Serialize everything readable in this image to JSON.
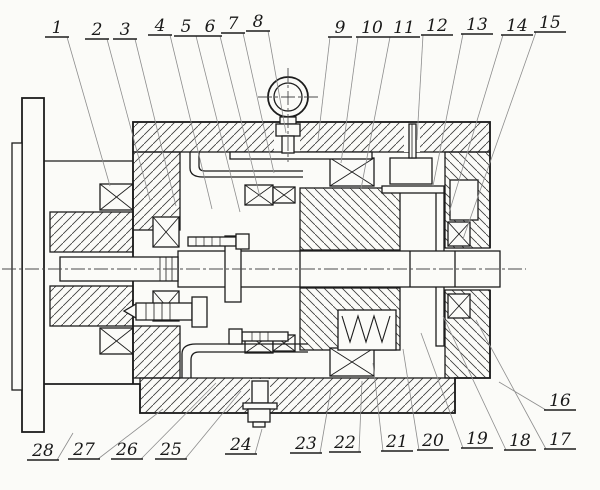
{
  "page": {
    "background": "#fbfbf8",
    "line_color": "#1c1c1c",
    "leader_color": "#8d8d8d",
    "description": "Mechanical assembly cross-section drawing with numbered part callouts 1-28"
  },
  "figure": {
    "part_numbers": [
      "1",
      "2",
      "3",
      "4",
      "5",
      "6",
      "7",
      "8",
      "9",
      "10",
      "11",
      "12",
      "13",
      "14",
      "15",
      "16",
      "17",
      "18",
      "19",
      "20",
      "21",
      "22",
      "23",
      "24",
      "25",
      "26",
      "27",
      "28"
    ],
    "part_labels": [
      {
        "number": "1",
        "x": 57,
        "y": 33,
        "tx": 110,
        "ty": 186,
        "attach": "right"
      },
      {
        "number": "2",
        "x": 97,
        "y": 35,
        "tx": 150,
        "ty": 200,
        "attach": "right"
      },
      {
        "number": "3",
        "x": 125,
        "y": 35,
        "tx": 176,
        "ty": 206,
        "attach": "right"
      },
      {
        "number": "4",
        "x": 160,
        "y": 31,
        "tx": 212,
        "ty": 209,
        "attach": "right"
      },
      {
        "number": "5",
        "x": 186,
        "y": 32,
        "tx": 240,
        "ty": 212,
        "attach": "right"
      },
      {
        "number": "6",
        "x": 210,
        "y": 32,
        "tx": 260,
        "ty": 197,
        "attach": "right"
      },
      {
        "number": "7",
        "x": 233,
        "y": 29,
        "tx": 274,
        "ty": 173,
        "attach": "right"
      },
      {
        "number": "8",
        "x": 258,
        "y": 27,
        "tx": 286,
        "ty": 133,
        "attach": "right"
      },
      {
        "number": "9",
        "x": 340,
        "y": 33,
        "tx": 318,
        "ty": 140,
        "attach": "left"
      },
      {
        "number": "10",
        "x": 372,
        "y": 33,
        "tx": 341,
        "ty": 163,
        "attach": "left"
      },
      {
        "number": "11",
        "x": 404,
        "y": 33,
        "tx": 361,
        "ty": 189,
        "attach": "left"
      },
      {
        "number": "12",
        "x": 437,
        "y": 31,
        "tx": 417,
        "ty": 140,
        "attach": "left"
      },
      {
        "number": "13",
        "x": 477,
        "y": 30,
        "tx": 433,
        "ty": 186,
        "attach": "left"
      },
      {
        "number": "14",
        "x": 517,
        "y": 31,
        "tx": 449,
        "ty": 213,
        "attach": "left"
      },
      {
        "number": "15",
        "x": 550,
        "y": 28,
        "tx": 463,
        "ty": 239,
        "attach": "left"
      },
      {
        "number": "16",
        "x": 560,
        "y": 406,
        "tx": 499,
        "ty": 382,
        "attach": "left"
      },
      {
        "number": "17",
        "x": 560,
        "y": 445,
        "tx": 476,
        "ty": 320,
        "attach": "left"
      },
      {
        "number": "18",
        "x": 520,
        "y": 446,
        "tx": 443,
        "ty": 316,
        "attach": "left"
      },
      {
        "number": "19",
        "x": 477,
        "y": 444,
        "tx": 421,
        "ty": 333,
        "attach": "left"
      },
      {
        "number": "20",
        "x": 433,
        "y": 446,
        "tx": 403,
        "ty": 349,
        "attach": "left"
      },
      {
        "number": "21",
        "x": 397,
        "y": 447,
        "tx": 373,
        "ty": 363,
        "attach": "left"
      },
      {
        "number": "22",
        "x": 345,
        "y": 448,
        "tx": 362,
        "ty": 381,
        "attach": "right"
      },
      {
        "number": "23",
        "x": 306,
        "y": 449,
        "tx": 331,
        "ty": 389,
        "attach": "right"
      },
      {
        "number": "24",
        "x": 241,
        "y": 450,
        "tx": 262,
        "ty": 429,
        "attach": "right"
      },
      {
        "number": "25",
        "x": 171,
        "y": 455,
        "tx": 241,
        "ty": 391,
        "attach": "right"
      },
      {
        "number": "26",
        "x": 127,
        "y": 455,
        "tx": 216,
        "ty": 383,
        "attach": "right"
      },
      {
        "number": "27",
        "x": 84,
        "y": 455,
        "tx": 163,
        "ty": 409,
        "attach": "right"
      },
      {
        "number": "28",
        "x": 43,
        "y": 456,
        "tx": 73,
        "ty": 433,
        "attach": "right"
      }
    ]
  }
}
